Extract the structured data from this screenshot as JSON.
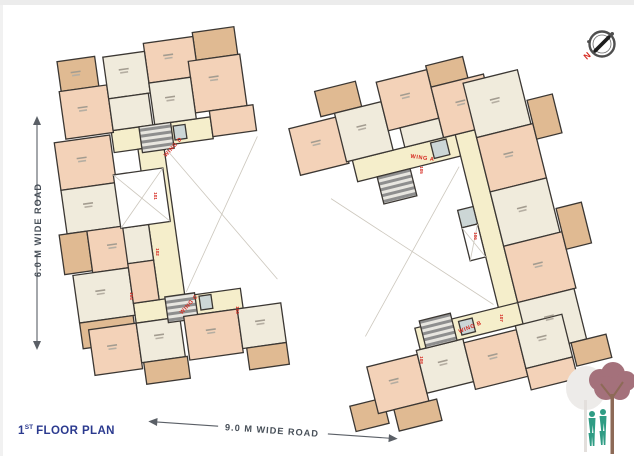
{
  "plan": {
    "title": {
      "floor_number": "1",
      "ordinal": "ST",
      "label": "FLOOR PLAN"
    },
    "roads": {
      "left_road": "6.0 M WIDE ROAD",
      "bottom_road": "9.0 M WIDE ROAD"
    },
    "compass": {
      "north": "N"
    },
    "wings": {
      "a": "WING A",
      "b": "WING B",
      "c": "WING C",
      "d": "WING D"
    },
    "unit_marks": [
      "101",
      "102",
      "103",
      "104",
      "105",
      "106",
      "107",
      "108"
    ],
    "colors": {
      "wall": "#3b3733",
      "room_cream": "#f0ebdc",
      "room_salmon": "#f3d2b8",
      "terrace_tan": "#e0ba92",
      "corridor_yellow": "#f5eecb",
      "accent_red": "#d5281f",
      "title_navy": "#2b3a8f",
      "road_text": "#474f58",
      "tree_mauve": "#a4717b",
      "people_teal": "#2f9c84"
    }
  }
}
